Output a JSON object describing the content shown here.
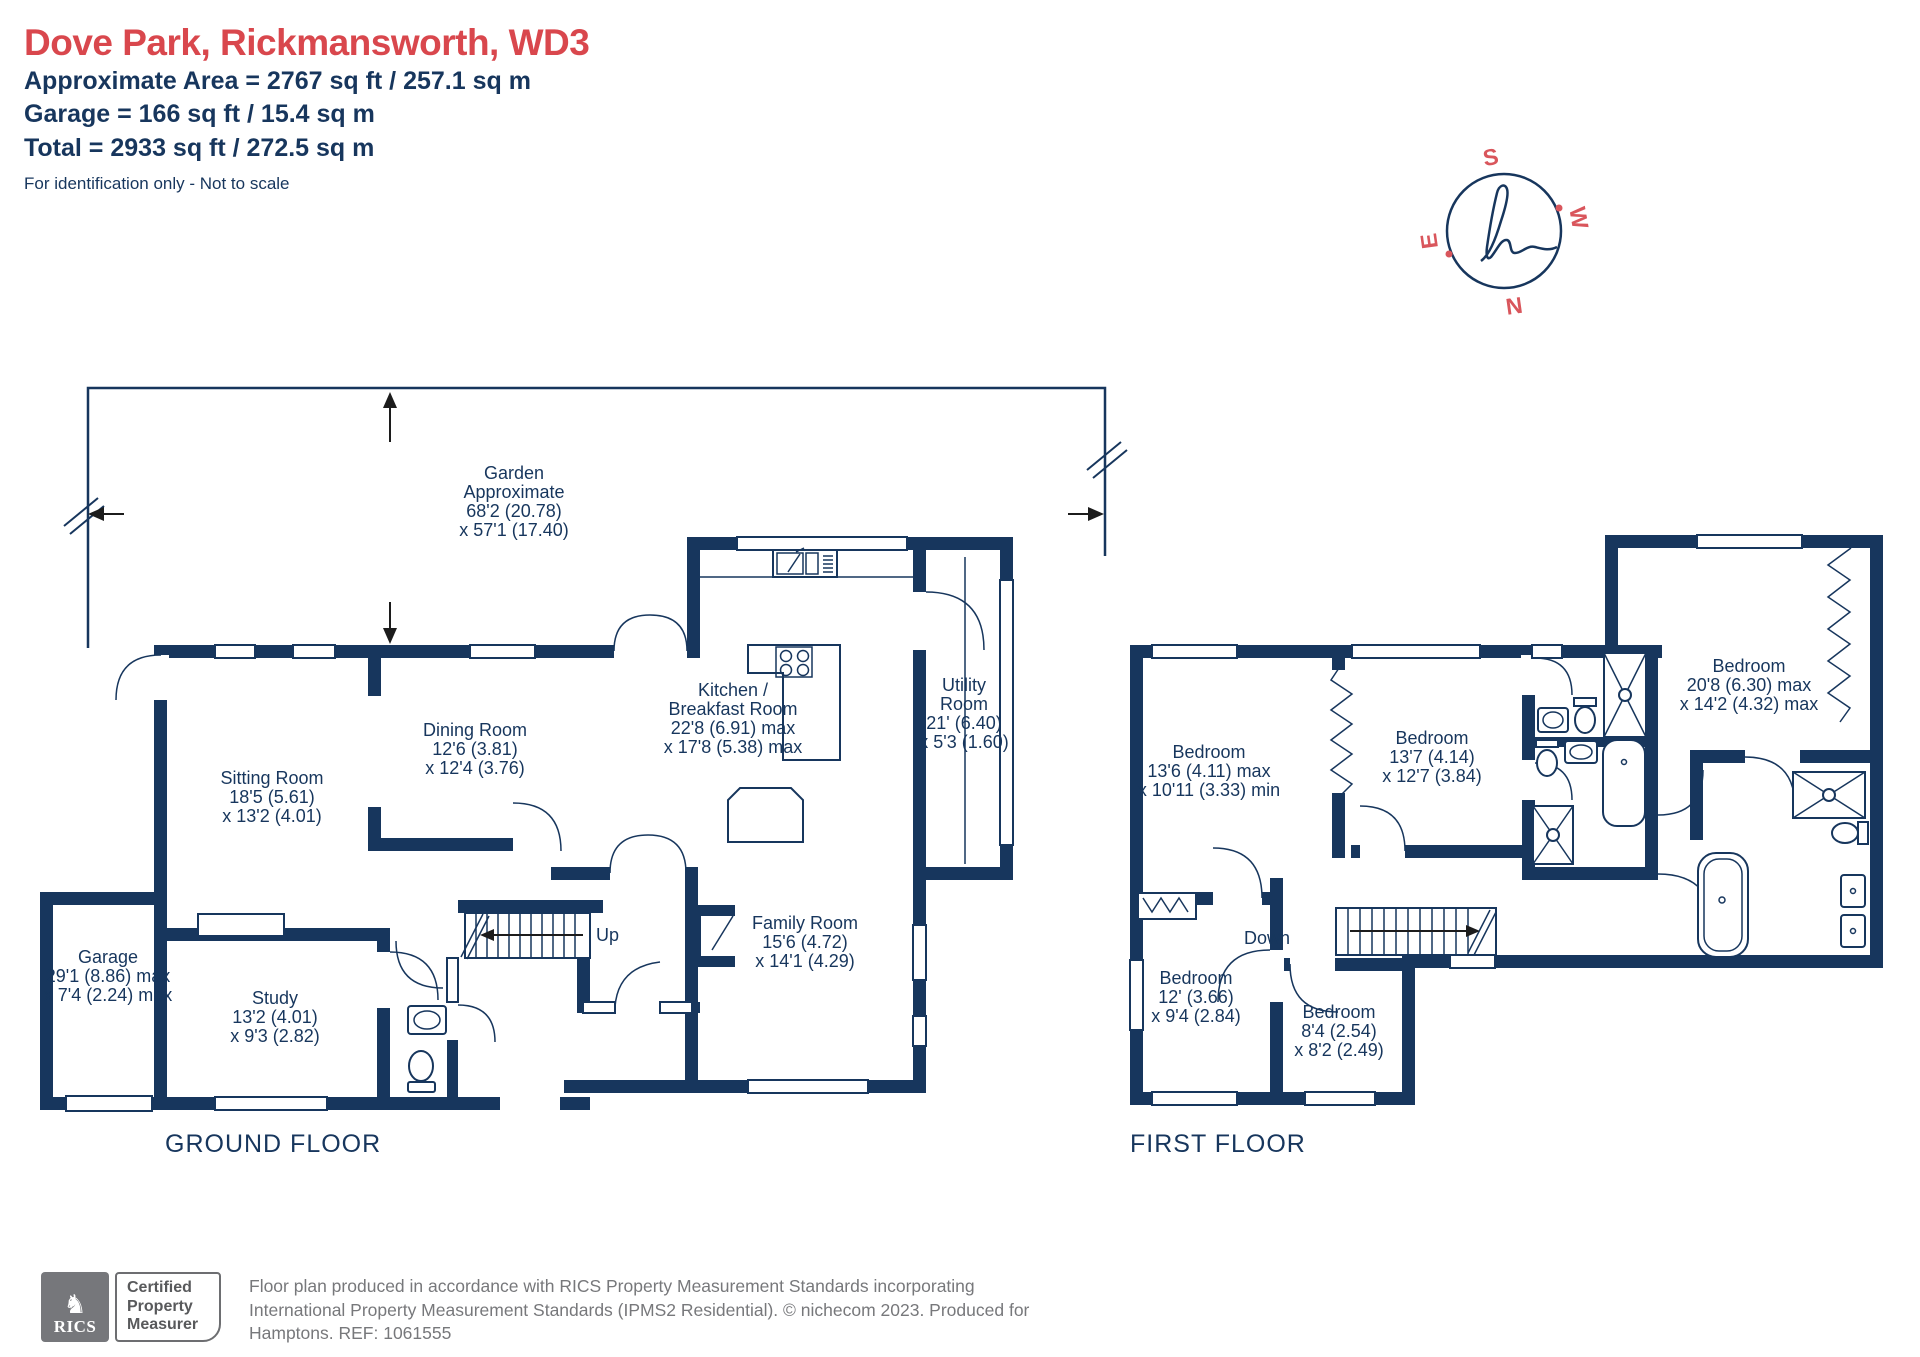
{
  "header": {
    "title": "Dove Park, Rickmansworth, WD3",
    "area_line": "Approximate Area = 2767 sq ft / 257.1 sq m",
    "garage_line": "Garage = 166 sq ft / 15.4 sq m",
    "total_line": "Total = 2933 sq ft / 272.5 sq m",
    "note": "For identification only - Not to scale"
  },
  "compass": {
    "s": "S",
    "w": "W",
    "n": "N",
    "e": "E"
  },
  "colors": {
    "navy": "#17365d",
    "red": "#d9474d",
    "footer_gray": "#77787b"
  },
  "ground_floor": {
    "label": "GROUND FLOOR",
    "stairs_label": "Up",
    "garden": {
      "name": "Garden",
      "line2": "Approximate",
      "dim1": "68'2 (20.78)",
      "dim2": "x 57'1 (17.40)"
    },
    "rooms": [
      {
        "name": "Sitting Room",
        "dim1": "18'5 (5.61)",
        "dim2": "x 13'2 (4.01)"
      },
      {
        "name": "Dining Room",
        "dim1": "12'6 (3.81)",
        "dim2": "x 12'4 (3.76)"
      },
      {
        "name": "Kitchen /",
        "name2": "Breakfast Room",
        "dim1": "22'8 (6.91) max",
        "dim2": "x 17'8 (5.38) max"
      },
      {
        "name": "Utility",
        "name2": "Room",
        "dim1": "21' (6.40)",
        "dim2": "x 5'3 (1.60)"
      },
      {
        "name": "Family Room",
        "dim1": "15'6 (4.72)",
        "dim2": "x 14'1 (4.29)"
      },
      {
        "name": "Study",
        "dim1": "13'2 (4.01)",
        "dim2": "x 9'3 (2.82)"
      },
      {
        "name": "Garage",
        "dim1": "29'1 (8.86) max",
        "dim2": "x 7'4 (2.24) max"
      }
    ]
  },
  "first_floor": {
    "label": "FIRST FLOOR",
    "stairs_label": "Down",
    "rooms": [
      {
        "name": "Bedroom",
        "dim1": "13'6 (4.11) max",
        "dim2": "x 10'11 (3.33) min"
      },
      {
        "name": "Bedroom",
        "dim1": "13'7 (4.14)",
        "dim2": "x 12'7 (3.84)"
      },
      {
        "name": "Bedroom",
        "dim1": "20'8 (6.30) max",
        "dim2": "x 14'2 (4.32) max"
      },
      {
        "name": "Bedroom",
        "dim1": "12' (3.66)",
        "dim2": "x 9'4 (2.84)"
      },
      {
        "name": "Bedroom",
        "dim1": "8'4 (2.54)",
        "dim2": "x 8'2 (2.49)"
      }
    ]
  },
  "footer": {
    "rics_label": "RICS",
    "badge_line1": "Certified",
    "badge_line2": "Property",
    "badge_line3": "Measurer",
    "text_line1": "Floor plan produced in accordance with RICS Property Measurement Standards incorporating",
    "text_line2": "International Property Measurement Standards (IPMS2 Residential).  © nichecom 2023.   Produced for",
    "text_line3": "Hamptons.   REF: 1061555"
  }
}
